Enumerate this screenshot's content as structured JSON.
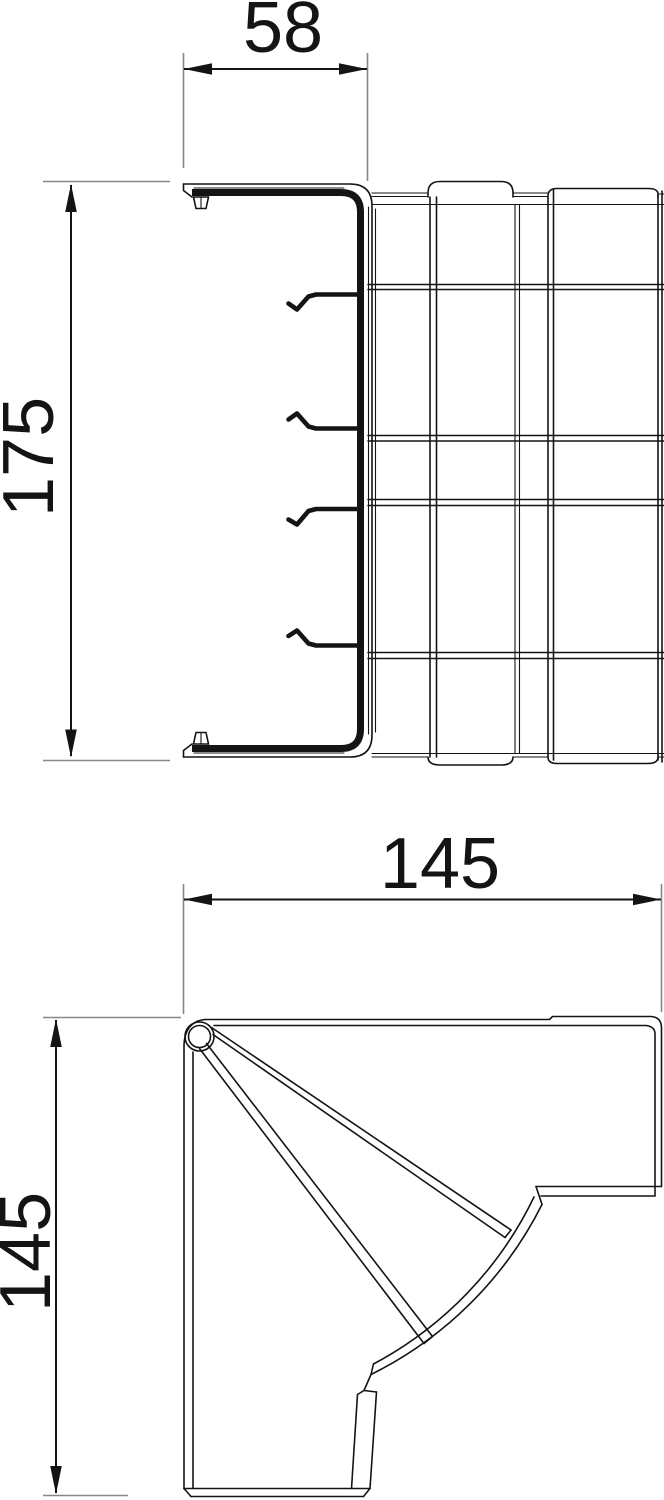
{
  "drawing": {
    "type": "technical-dimension-drawing",
    "colors": {
      "background": "#ffffff",
      "line": "#141414",
      "reference_line": "#878787"
    },
    "views": [
      {
        "id": "profile-view",
        "description": "C-profile side view of trunking corner with cover lid and retaining hooks",
        "dims": [
          {
            "label": "58"
          },
          {
            "label": "175"
          }
        ]
      },
      {
        "id": "plan-view",
        "description": "Plan view of internal corner with hinge and segmented cover fan",
        "dims": [
          {
            "label": "145"
          },
          {
            "label": "145"
          }
        ]
      }
    ]
  }
}
